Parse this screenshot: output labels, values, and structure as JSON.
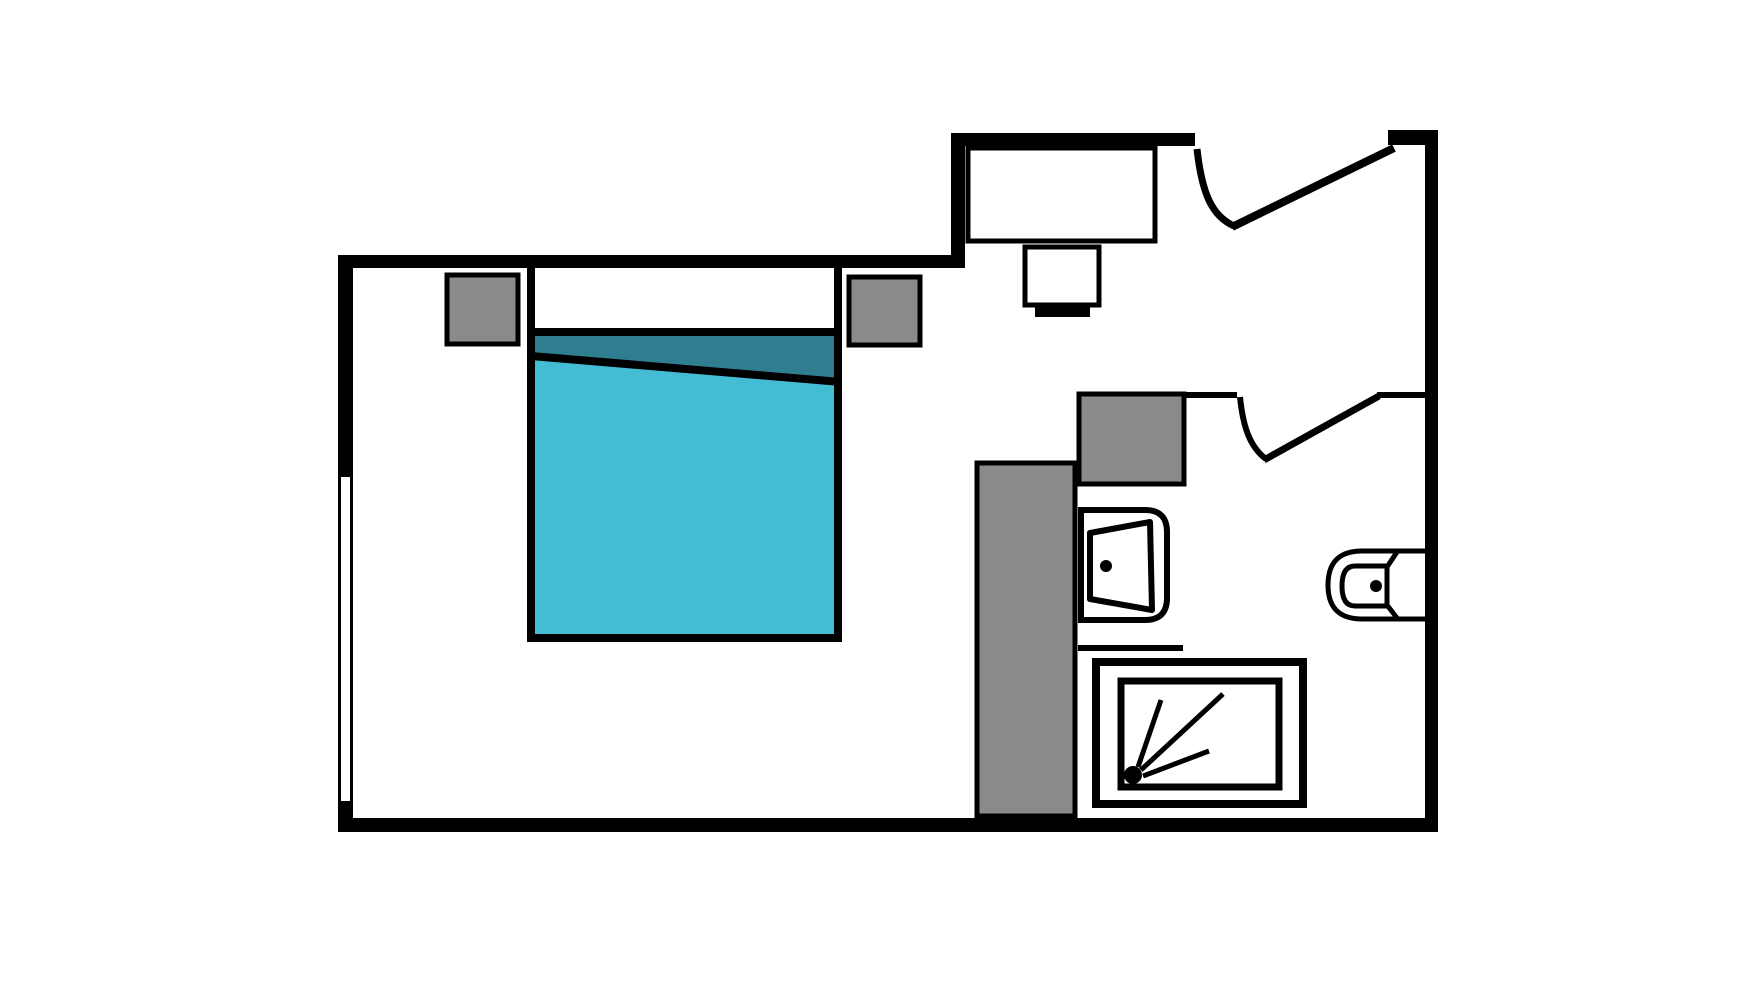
{
  "meta": {
    "description": "studio-apartment-floor-plan",
    "canvas_width": 1760,
    "canvas_height": 990,
    "background": "#ffffff"
  },
  "colors": {
    "wall": "#000000",
    "furniture_gray": "#8a8a8a",
    "bed_blanket_teal": "#44bdd4",
    "bed_fold_dark_teal": "#2e7e8f",
    "fixture_white": "#ffffff"
  },
  "shapes": [
    {
      "name": "bed-base",
      "type": "rect",
      "x": 531,
      "y": 266,
      "w": 307,
      "h": 372,
      "fill": "#ffffff"
    },
    {
      "name": "bed-sheet-fold",
      "type": "polygon",
      "points": "535,336 838,336 838,379 535,354",
      "fill": "#2e7e8f"
    },
    {
      "name": "bed-blanket",
      "type": "polygon",
      "points": "535,358 838,383 838,636 535,636",
      "fill": "#44bdd4"
    },
    {
      "name": "bed-fold-line",
      "type": "line",
      "x1": 531,
      "y1": 356,
      "x2": 841,
      "y2": 382,
      "stroke": "#000000",
      "sw": 8
    },
    {
      "name": "bed-pillow-line",
      "type": "line",
      "x1": 531,
      "y1": 332,
      "x2": 838,
      "y2": 332,
      "stroke": "#000000",
      "sw": 8
    },
    {
      "name": "bed-outline",
      "type": "path",
      "d": "M 531 262 L 531 638 L 838 638 L 838 262",
      "fill": "none",
      "stroke": "#000000",
      "sw": 8
    },
    {
      "name": "nightstand-left",
      "type": "rect",
      "x": 447,
      "y": 275,
      "w": 71,
      "h": 69,
      "fill": "#8a8a8a",
      "stroke": "#000000",
      "sw": 5
    },
    {
      "name": "nightstand-right",
      "type": "rect",
      "x": 849,
      "y": 277,
      "w": 71,
      "h": 68,
      "fill": "#8a8a8a",
      "stroke": "#000000",
      "sw": 5
    },
    {
      "name": "desk",
      "type": "rect",
      "x": 968,
      "y": 148,
      "w": 187,
      "h": 93,
      "fill": "#ffffff",
      "stroke": "#000000",
      "sw": 5
    },
    {
      "name": "desk-chair",
      "type": "rect",
      "x": 1025,
      "y": 247,
      "w": 74,
      "h": 58,
      "fill": "#ffffff",
      "stroke": "#000000",
      "sw": 5
    },
    {
      "name": "desk-chair-base",
      "type": "rect",
      "x": 1035,
      "y": 307,
      "w": 55,
      "h": 10,
      "fill": "#000000"
    },
    {
      "name": "closet-unit",
      "type": "rect",
      "x": 1079,
      "y": 394,
      "w": 105,
      "h": 90,
      "fill": "#8a8a8a",
      "stroke": "#000000",
      "sw": 5
    },
    {
      "name": "bathroom-partition",
      "type": "rect",
      "x": 977,
      "y": 463,
      "w": 98,
      "h": 353,
      "fill": "#8a8a8a",
      "stroke": "#000000",
      "sw": 5
    },
    {
      "name": "half-wall-shower",
      "type": "rect",
      "x": 1078,
      "y": 645,
      "w": 105,
      "h": 6,
      "fill": "#000000"
    },
    {
      "name": "sink-counter",
      "type": "path",
      "d": "M 1081 510 L 1145 510 Q 1167 510 1167 532 L 1167 598 Q 1167 620 1145 620 L 1081 620 Z",
      "fill": "#ffffff",
      "stroke": "#000000",
      "sw": 6
    },
    {
      "name": "sink-bowl",
      "type": "polygon",
      "points": "1090,533 1150,522 1152,610 1090,599",
      "fill": "#ffffff",
      "stroke": "#000000",
      "sw": 6,
      "join": "round"
    },
    {
      "name": "sink-drain",
      "type": "circle",
      "cx": 1106,
      "cy": 566,
      "r": 6,
      "fill": "#000000"
    },
    {
      "name": "toilet-body",
      "type": "path",
      "d": "M 1425 551 L 1362 551 Q 1328 551 1328 585 Q 1328 619 1362 619 L 1425 619",
      "fill": "#ffffff",
      "stroke": "#000000",
      "sw": 5
    },
    {
      "name": "toilet-bowl",
      "type": "path",
      "d": "M 1387 566 L 1355 566 Q 1342 566 1342 586 Q 1342 606 1355 606 L 1387 606 Z",
      "fill": "#ffffff",
      "stroke": "#000000",
      "sw": 5,
      "join": "round"
    },
    {
      "name": "toilet-tank-bevel-top",
      "type": "line",
      "x1": 1387,
      "y1": 567,
      "x2": 1397,
      "y2": 552,
      "stroke": "#000000",
      "sw": 5
    },
    {
      "name": "toilet-tank-bevel-bottom",
      "type": "line",
      "x1": 1387,
      "y1": 605,
      "x2": 1397,
      "y2": 618,
      "stroke": "#000000",
      "sw": 5
    },
    {
      "name": "toilet-flush-dot",
      "type": "circle",
      "cx": 1376,
      "cy": 586,
      "r": 6,
      "fill": "#000000"
    },
    {
      "name": "shower-tray",
      "type": "rect",
      "x": 1096,
      "y": 662,
      "w": 207,
      "h": 142,
      "fill": "#ffffff",
      "stroke": "#000000",
      "sw": 8
    },
    {
      "name": "shower-basin",
      "type": "rect",
      "x": 1121,
      "y": 681,
      "w": 158,
      "h": 106,
      "fill": "#ffffff",
      "stroke": "#000000",
      "sw": 7
    },
    {
      "name": "shower-spray-line-1",
      "type": "line",
      "x1": 1138,
      "y1": 767,
      "x2": 1161,
      "y2": 700,
      "stroke": "#000000",
      "sw": 5
    },
    {
      "name": "shower-spray-line-2",
      "type": "line",
      "x1": 1141,
      "y1": 770,
      "x2": 1223,
      "y2": 694,
      "stroke": "#000000",
      "sw": 5
    },
    {
      "name": "shower-spray-line-3",
      "type": "line",
      "x1": 1143,
      "y1": 776,
      "x2": 1209,
      "y2": 751,
      "stroke": "#000000",
      "sw": 5
    },
    {
      "name": "shower-head-dot",
      "type": "circle",
      "cx": 1133,
      "cy": 775,
      "r": 9,
      "fill": "#000000"
    },
    {
      "name": "wall-left",
      "type": "rect",
      "x": 338,
      "y": 255,
      "w": 15,
      "h": 577,
      "fill": "#000000"
    },
    {
      "name": "wall-top-bedroom",
      "type": "rect",
      "x": 338,
      "y": 255,
      "w": 627,
      "h": 13,
      "fill": "#000000"
    },
    {
      "name": "wall-nook-left",
      "type": "rect",
      "x": 951,
      "y": 133,
      "w": 14,
      "h": 135,
      "fill": "#000000"
    },
    {
      "name": "wall-nook-top",
      "type": "rect",
      "x": 951,
      "y": 133,
      "w": 244,
      "h": 13,
      "fill": "#000000"
    },
    {
      "name": "wall-stub-top-right",
      "type": "rect",
      "x": 1388,
      "y": 130,
      "w": 50,
      "h": 15,
      "fill": "#000000"
    },
    {
      "name": "wall-right",
      "type": "rect",
      "x": 1425,
      "y": 130,
      "w": 13,
      "h": 702,
      "fill": "#000000"
    },
    {
      "name": "wall-bottom",
      "type": "rect",
      "x": 338,
      "y": 818,
      "w": 1100,
      "h": 14,
      "fill": "#000000"
    },
    {
      "name": "wall-bath-entry-left",
      "type": "rect",
      "x": 1185,
      "y": 392,
      "w": 52,
      "h": 6,
      "fill": "#000000"
    },
    {
      "name": "wall-bath-entry-right",
      "type": "rect",
      "x": 1377,
      "y": 392,
      "w": 48,
      "h": 6,
      "fill": "#000000"
    },
    {
      "name": "window-left-wall",
      "type": "rect",
      "x": 341,
      "y": 477,
      "w": 9,
      "h": 324,
      "fill": "#ffffff"
    },
    {
      "name": "entry-door-swing-arc",
      "type": "path",
      "d": "M 1197 149 C 1202 194 1212 216 1234 226",
      "fill": "none",
      "stroke": "#000000",
      "sw": 7
    },
    {
      "name": "entry-door-leaf",
      "type": "line",
      "x1": 1232,
      "y1": 227,
      "x2": 1394,
      "y2": 148,
      "stroke": "#000000",
      "sw": 8
    },
    {
      "name": "bathroom-door-swing-arc",
      "type": "path",
      "d": "M 1240 397 C 1243 427 1250 447 1266 459",
      "fill": "none",
      "stroke": "#000000",
      "sw": 6
    },
    {
      "name": "bathroom-door-leaf",
      "type": "line",
      "x1": 1264,
      "y1": 460,
      "x2": 1379,
      "y2": 396,
      "stroke": "#000000",
      "sw": 7
    }
  ]
}
